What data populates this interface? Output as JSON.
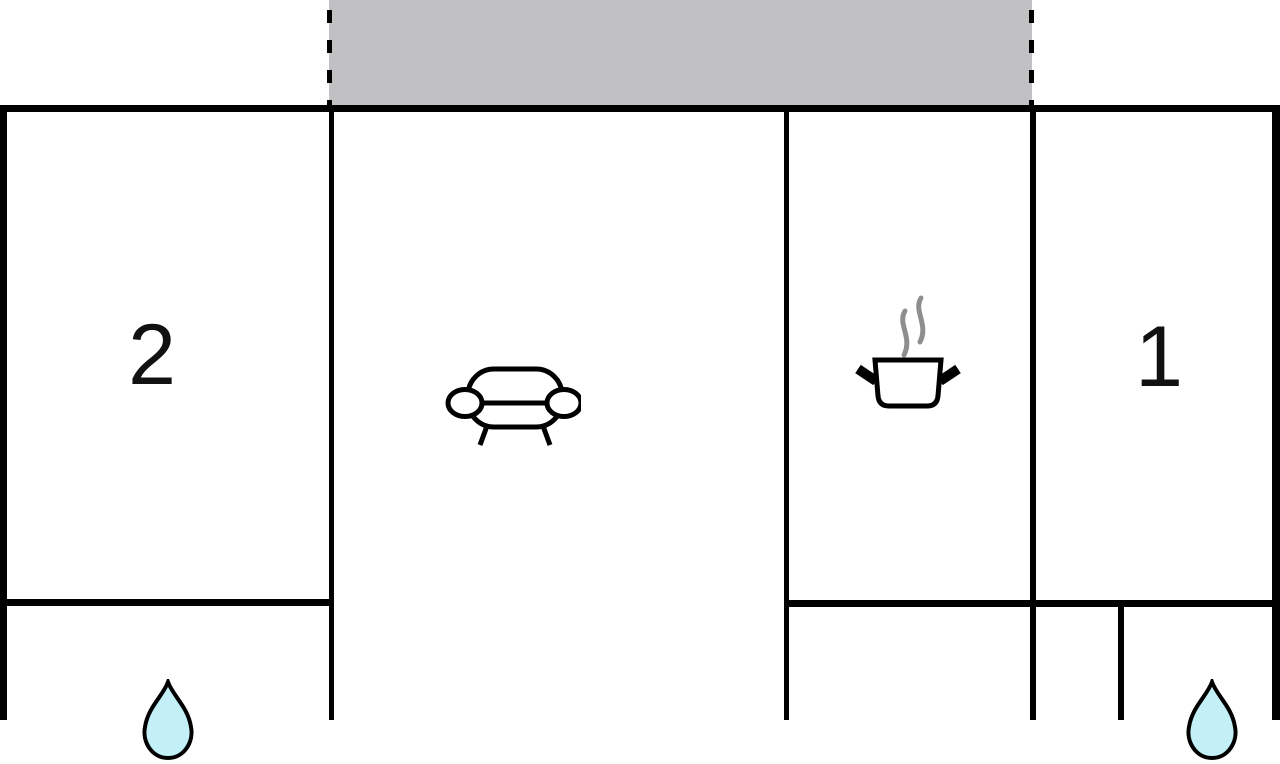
{
  "floor_plan": {
    "balcony": {
      "name": "balcony"
    },
    "rooms": {
      "bedroom_2": {
        "label": "2"
      },
      "bedroom_1": {
        "label": "1"
      },
      "living_room": {
        "icon": "sofa-icon"
      },
      "kitchen": {
        "icon": "cooking-pot-icon"
      },
      "bathroom_left": {
        "icon": "water-drop-icon"
      },
      "bathroom_right": {
        "icon": "water-drop-icon"
      }
    },
    "icons": [
      "sofa-icon",
      "cooking-pot-icon",
      "steam-icon",
      "water-drop-icon",
      "water-drop-icon"
    ],
    "colors": {
      "wall": "#000000",
      "background": "#ffffff",
      "balcony_fill": "#c1c1c3",
      "drop_fill": "#c2f0f6",
      "drop_stroke": "#000000",
      "steam": "#8e8e8e",
      "label_color": "#111111"
    }
  }
}
